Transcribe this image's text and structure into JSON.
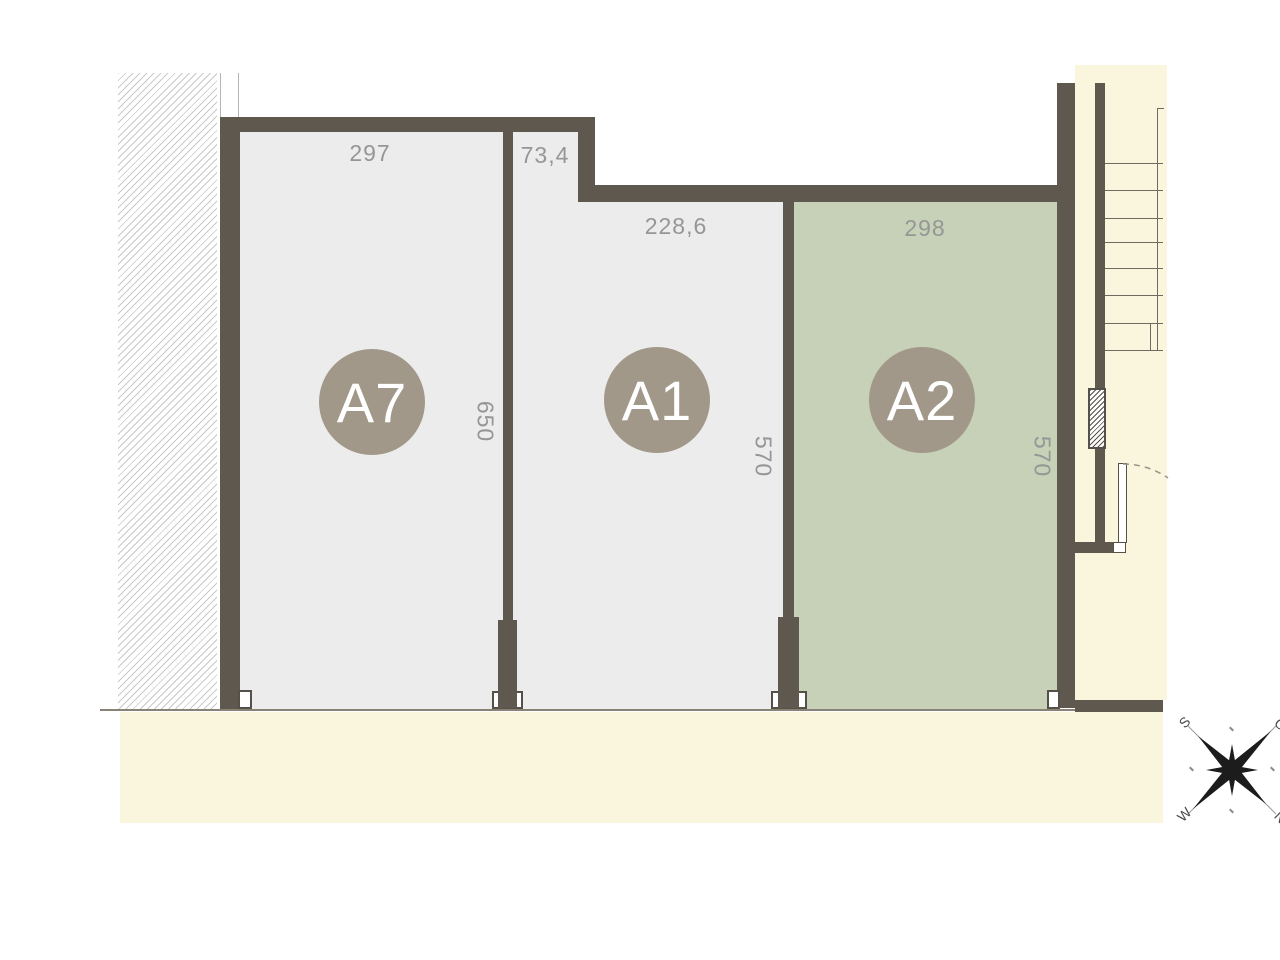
{
  "plan": {
    "type": "floor-plan",
    "highlighted_unit": "A2"
  },
  "units": [
    {
      "label": "A7",
      "top_dim": "297",
      "side_dim": "650",
      "fill": "light-gray"
    },
    {
      "label": "A1",
      "top_dim": "228,6",
      "entry_dim": "73,4",
      "side_dim": "570",
      "fill": "light-gray"
    },
    {
      "label": "A2",
      "top_dim": "298",
      "side_dim": "570",
      "fill": "green"
    }
  ],
  "compass": {
    "north": "N",
    "east": "O",
    "south": "S",
    "west": "W"
  },
  "colors": {
    "wall": "#5f584e",
    "room_light": "#ececec",
    "room_highlight": "#c6d1b7",
    "floor_cream": "#faf6dd",
    "badge": "#a29889",
    "dim_text": "#969696",
    "hatch_line": "#c9c9c9",
    "stair_line": "#6f695f",
    "glass_line": "#8a8274"
  }
}
